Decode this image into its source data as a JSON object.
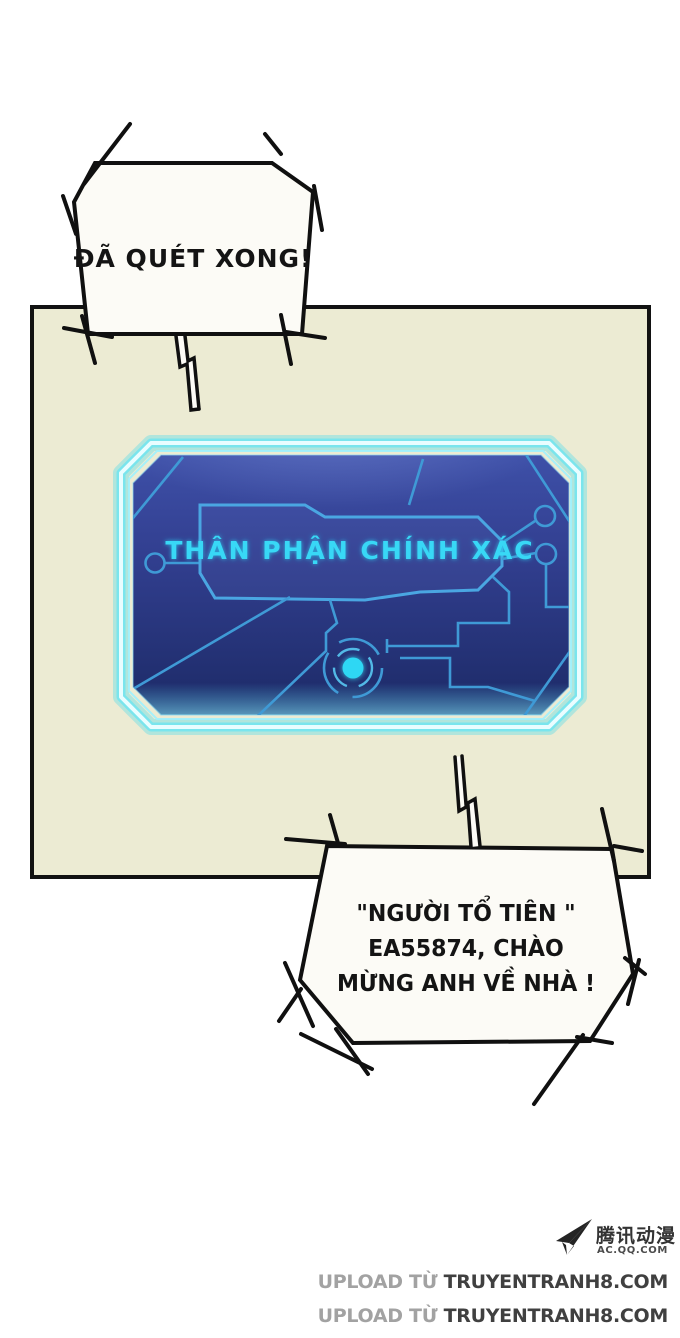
{
  "speech": {
    "top_bubble": {
      "text": "ĐÃ QUÉT XONG!"
    },
    "bottom_bubble": {
      "line1": "\"NGƯỜI TỔ TIÊN \"",
      "line2": "EA55874, CHÀO",
      "line3": "MỪNG ANH VỀ NHÀ !"
    }
  },
  "screen": {
    "label": "THÂN PHẬN CHÍNH XÁC",
    "colors": {
      "glow": "#35dcf5",
      "frame_core": "#e9fdff",
      "bg_top": "#3e50a8",
      "bg_bottom": "#1c2a66",
      "circuit": "#3f9ad6",
      "label_text": "#38d8f6",
      "dot": "#2ed7f4"
    }
  },
  "panel": {
    "bg": "#ecebd3",
    "border": "#121212"
  },
  "watermark": {
    "publisher": {
      "icon": "paper-plane-icon",
      "name": "腾讯动漫",
      "site": "AC.QQ.COM"
    },
    "credits": [
      {
        "prefix": "UPLOAD TỪ ",
        "site": "TRUYENTRANH8.COM"
      },
      {
        "prefix": "UPLOAD TỪ ",
        "site": "TRUYENTRANH8.COM"
      }
    ]
  }
}
